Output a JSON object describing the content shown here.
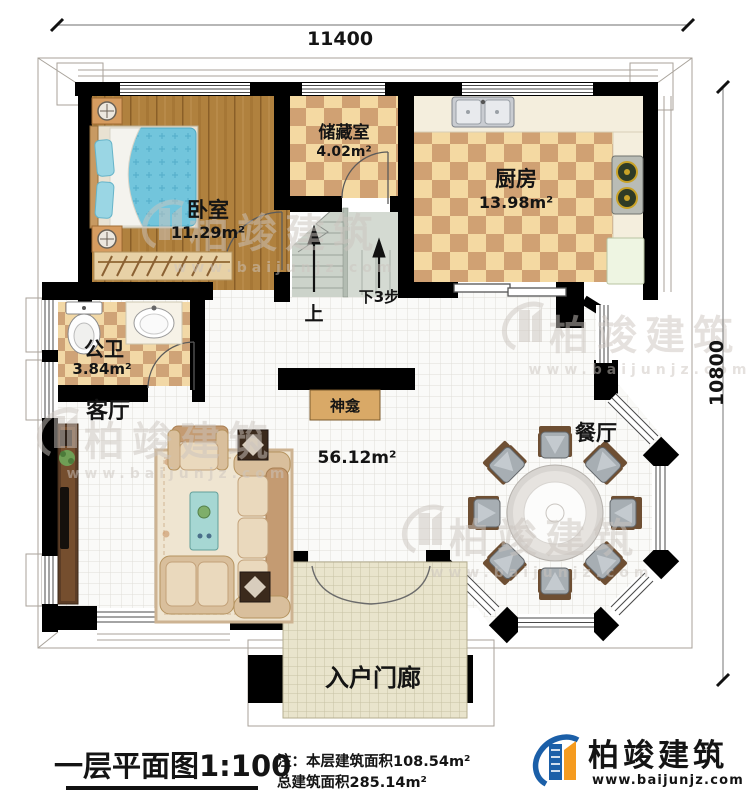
{
  "plan": {
    "dimensions": {
      "top": "11400",
      "right": "10800"
    },
    "rooms": {
      "bedroom": {
        "name": "卧室",
        "area": "11.29m²"
      },
      "storage": {
        "name": "储藏室",
        "area": "4.02m²"
      },
      "kitchen": {
        "name": "厨房",
        "area": "13.98m²"
      },
      "bathroom": {
        "name": "公卫",
        "area": "3.84m²"
      },
      "living": {
        "name": "客厅",
        "area": "56.12m²"
      },
      "dining": {
        "name": "餐厅"
      },
      "porch": {
        "name": "入户门廊"
      },
      "shrine": {
        "name": "神龛"
      }
    },
    "stairs": {
      "up": "上",
      "down": "下3步"
    }
  },
  "footer": {
    "title": "一层平面图1:100",
    "note_line1": "注：本层建筑面积108.54m²",
    "note_line2": "总建筑面积285.14m²"
  },
  "brand": {
    "name": "柏竣建筑",
    "website": "www.baijunjz.com"
  },
  "watermark": {
    "name": "柏竣建筑",
    "website": "www.baijunjz.com"
  },
  "colors": {
    "wall": "#000000",
    "wood_floor": "#b0813e",
    "checker_light": "#f4d9a2",
    "checker_dark": "#d0a173",
    "bed_blue": "#72c5dc",
    "brand_blue": "#1b5fa8",
    "brand_orange": "#f59b1f",
    "watermark_gray": "#ccc5bf"
  }
}
